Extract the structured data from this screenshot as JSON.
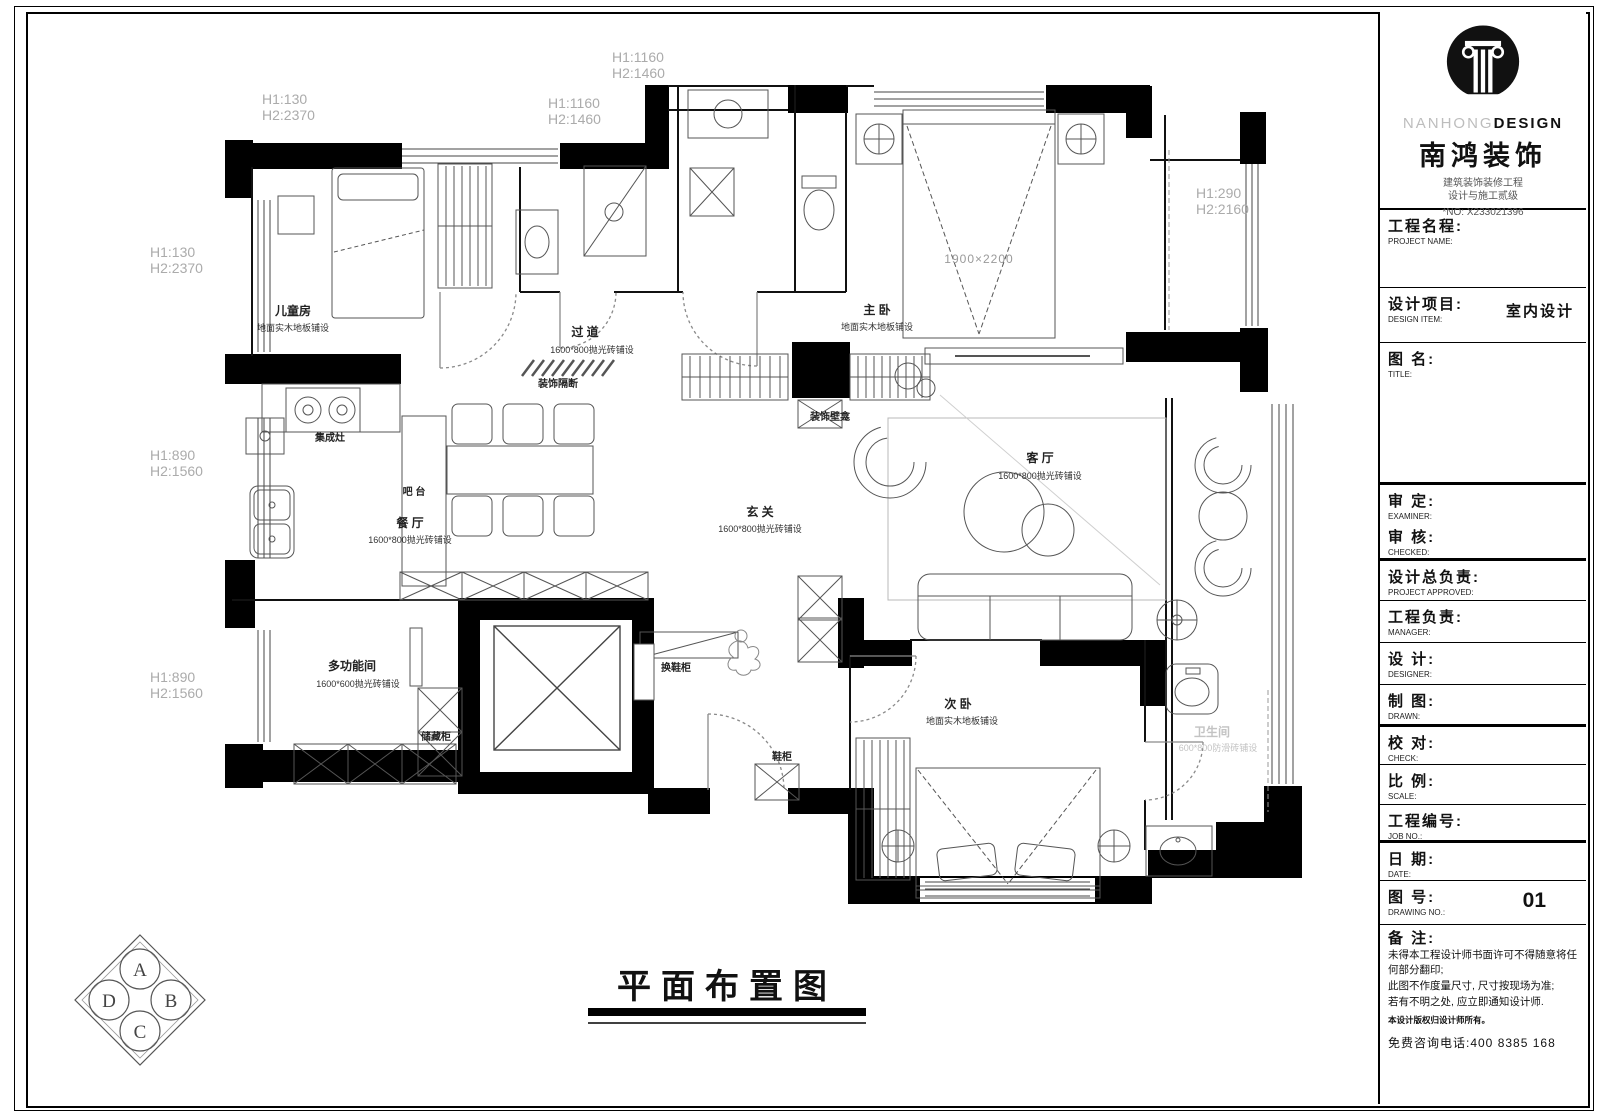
{
  "logo": {
    "brand_en_light": "NANHONG",
    "brand_en_bold": "DESIGN",
    "brand_cn": "南鸿装饰",
    "cert_line1": "建筑装饰装修工程",
    "cert_line2": "设计与施工贰级",
    "cert_no": "*NO: X233021396"
  },
  "titleblock": {
    "project_name": {
      "cn": "工程名程:",
      "en": "PROJECT NAME:"
    },
    "design_item": {
      "cn": "设计项目:",
      "en": "DESIGN ITEM:",
      "value": "室内设计"
    },
    "drawing_title": {
      "cn": "图  名:",
      "en": "TITLE:"
    },
    "examiner": {
      "cn": "审  定:",
      "en": "EXAMINER:"
    },
    "checked": {
      "cn": "审  核:",
      "en": "CHECKED:"
    },
    "project_approved": {
      "cn": "设计总负责:",
      "en": "PROJECT APPROVED:"
    },
    "manager": {
      "cn": "工程负责:",
      "en": "MANAGER:"
    },
    "designer": {
      "cn": "设  计:",
      "en": "DESIGNER:"
    },
    "drawn": {
      "cn": "制  图:",
      "en": "DRAWN:"
    },
    "check": {
      "cn": "校  对:",
      "en": "CHECK:"
    },
    "scale": {
      "cn": "比  例:",
      "en": "SCALE:"
    },
    "job_no": {
      "cn": "工程编号:",
      "en": "JOB NO.:"
    },
    "date": {
      "cn": "日  期:",
      "en": "DATE:"
    },
    "drawing_no": {
      "cn": "图  号:",
      "en": "DRAWING NO.:",
      "value": "01"
    },
    "remark": {
      "cn": "备  注:",
      "lines": [
        "未得本工程设计师书面许可不得随意将任何部分翻印;",
        "此图不作度量尺寸, 尺寸按现场为准;",
        "若有不明之处, 应立即通知设计师."
      ],
      "copyright": "本设计版权归设计师所有。",
      "hotline": "免费咨询电话:400 8385 168"
    }
  },
  "plan": {
    "title": "平面布置图",
    "rooms": [
      {
        "name": "儿童房",
        "material": "地面实木地板铺设"
      },
      {
        "name": "过  道",
        "material": "1600*800抛光砖铺设"
      },
      {
        "name": "主  卧",
        "material": "地面实木地板铺设"
      },
      {
        "name": "客  厅",
        "material": "1600*800抛光砖铺设"
      },
      {
        "name": "玄  关",
        "material": "1600*800抛光砖铺设"
      },
      {
        "name": "餐  厅",
        "material": "1600*800抛光砖铺设"
      },
      {
        "name": "多功能间",
        "material": "1600*600抛光砖铺设"
      },
      {
        "name": "次  卧",
        "material": "地面实木地板铺设"
      },
      {
        "name": "卫生间",
        "material": "600*800防滑砖铺设"
      }
    ],
    "labels": {
      "stove": "集成灶",
      "bar": "吧  台",
      "partition": "装饰隔断",
      "niche": "装饰壁龛",
      "storage": "储藏柜",
      "shoe_change": "换鞋柜",
      "shoe": "鞋柜",
      "bed_size": "1900×2200"
    },
    "dims": [
      {
        "l1": "H1:130",
        "l2": "H2:2370"
      },
      {
        "l1": "H1:1160",
        "l2": "H2:1460"
      },
      {
        "l1": "H1:1160",
        "l2": "H2:1460"
      },
      {
        "l1": "H1:130",
        "l2": "H2:2370"
      },
      {
        "l1": "H1:290",
        "l2": "H2:2160"
      },
      {
        "l1": "H1:890",
        "l2": "H2:1560"
      },
      {
        "l1": "H1:890",
        "l2": "H2:1560"
      }
    ],
    "compass": {
      "a": "A",
      "b": "B",
      "c": "C",
      "d": "D"
    }
  }
}
